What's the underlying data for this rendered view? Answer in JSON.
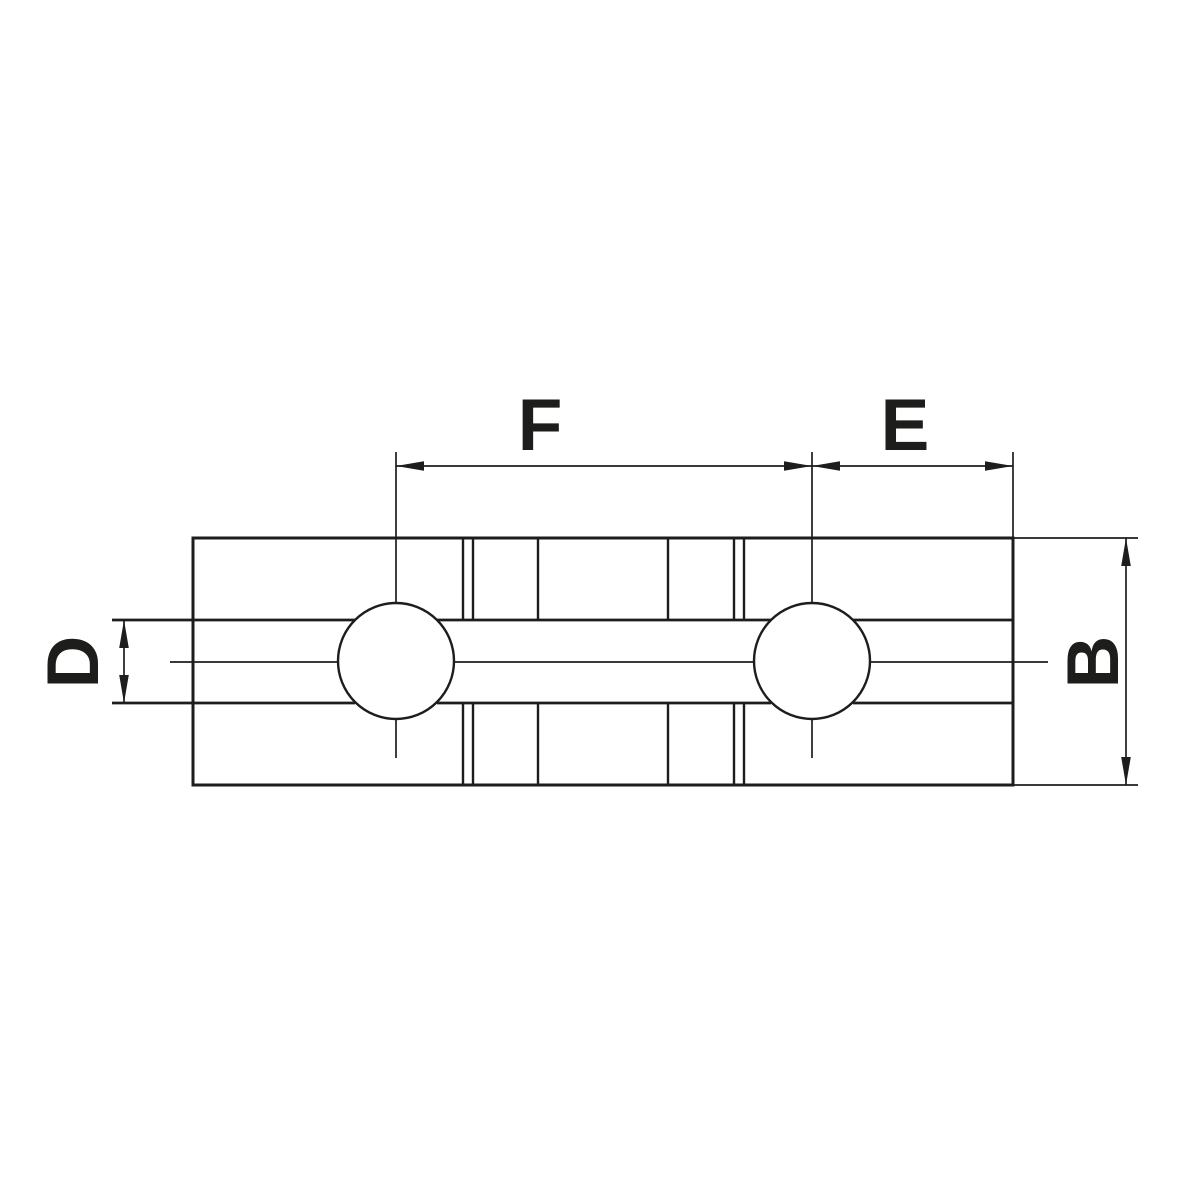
{
  "drawing": {
    "colors": {
      "line": "#1d1d1b",
      "background": "#ffffff"
    },
    "dimension_labels": {
      "f": "F",
      "e": "E",
      "d": "D",
      "b": "B"
    },
    "geometry": {
      "outline": {
        "x": 193,
        "y": 538,
        "width": 820,
        "height": 247,
        "stroke_width": 3
      },
      "holes": [
        {
          "cx": 396,
          "cy": 661,
          "r": 58
        },
        {
          "cx": 812,
          "cy": 661,
          "r": 58
        }
      ],
      "hole_stroke_width": 2.4,
      "line_groups": [
        {
          "name": "slot-edge-lines",
          "stroke_width": 2.8,
          "segments": [
            [
              112,
              620,
              355,
              620
            ],
            [
              437,
              620,
              771,
              620
            ],
            [
              853,
              620,
              1013,
              620
            ],
            [
              112,
              703,
              355,
              703
            ],
            [
              437,
              703,
              771,
              703
            ],
            [
              853,
              703,
              1013,
              703
            ]
          ]
        },
        {
          "name": "groove-vertical-lines",
          "stroke_width": 2.4,
          "segments": [
            [
              463,
              538,
              463,
              620
            ],
            [
              473,
              538,
              473,
              620
            ],
            [
              538,
              538,
              538,
              620
            ],
            [
              668,
              538,
              668,
              620
            ],
            [
              734,
              538,
              734,
              620
            ],
            [
              744,
              538,
              744,
              620
            ],
            [
              463,
              703,
              463,
              785
            ],
            [
              473,
              703,
              473,
              785
            ],
            [
              538,
              703,
              538,
              785
            ],
            [
              668,
              703,
              668,
              785
            ],
            [
              734,
              703,
              734,
              785
            ],
            [
              744,
              703,
              744,
              785
            ]
          ]
        },
        {
          "name": "centerlines",
          "stroke_width": 1.7,
          "segments": [
            [
              170,
              662,
              338,
              662
            ],
            [
              454,
              662,
              754,
              662
            ],
            [
              870,
              662,
              1048,
              662
            ],
            [
              396,
              452,
              396,
              603
            ],
            [
              396,
              719,
              396,
              758
            ],
            [
              812,
              452,
              812,
              603
            ],
            [
              812,
              719,
              812,
              758
            ]
          ]
        },
        {
          "name": "extension-lines",
          "stroke_width": 1.7,
          "segments": [
            [
              1013,
              452,
              1013,
              538
            ],
            [
              1013,
              538,
              1138,
              538
            ],
            [
              1013,
              785,
              1138,
              785
            ]
          ]
        },
        {
          "name": "dimension-lines",
          "stroke_width": 1.7,
          "segments": [
            [
              396,
              466,
              812,
              466
            ],
            [
              812,
              466,
              1013,
              466
            ],
            [
              124,
              620,
              124,
              703
            ],
            [
              1126,
              538,
              1126,
              785
            ]
          ]
        }
      ],
      "arrowheads": {
        "length": 28,
        "half_width": 4.8,
        "items": [
          {
            "name": "dim-F-arrow-left",
            "tip": [
              396,
              466
            ],
            "dir": "left"
          },
          {
            "name": "dim-F-arrow-right",
            "tip": [
              812,
              466
            ],
            "dir": "right"
          },
          {
            "name": "dim-E-arrow-left",
            "tip": [
              812,
              466
            ],
            "dir": "left"
          },
          {
            "name": "dim-E-arrow-right",
            "tip": [
              1013,
              466
            ],
            "dir": "right"
          },
          {
            "name": "dim-D-arrow-up",
            "tip": [
              124,
              620
            ],
            "dir": "up"
          },
          {
            "name": "dim-D-arrow-down",
            "tip": [
              124,
              703
            ],
            "dir": "down"
          },
          {
            "name": "dim-B-arrow-up",
            "tip": [
              1126,
              538
            ],
            "dir": "up"
          },
          {
            "name": "dim-B-arrow-down",
            "tip": [
              1126,
              785
            ],
            "dir": "down"
          }
        ]
      }
    }
  }
}
